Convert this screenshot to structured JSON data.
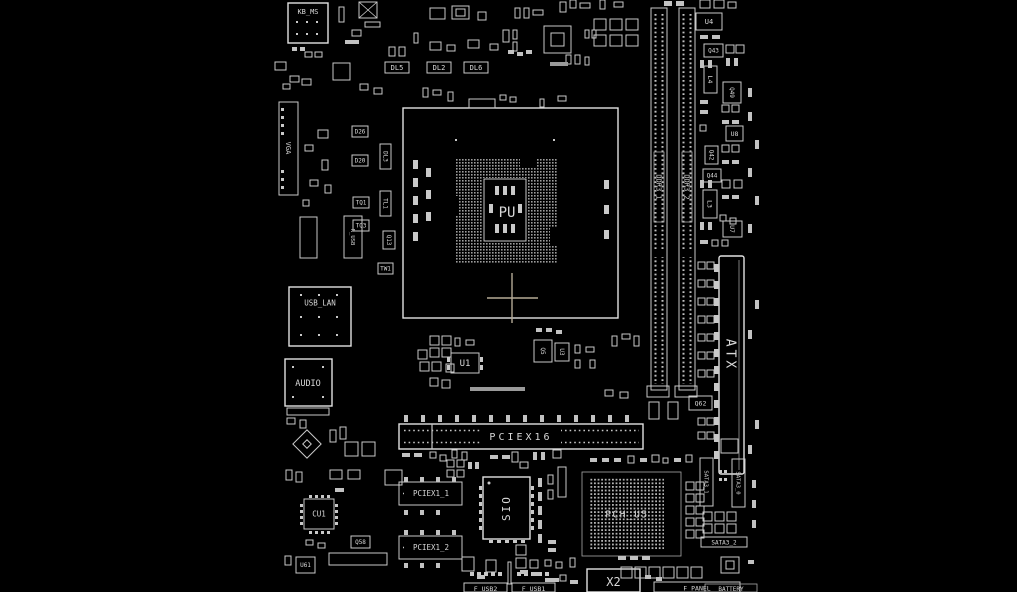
{
  "diagram": {
    "title": "motherboard-boardview",
    "colors": {
      "background": "#000000",
      "line": "#e2e2e2",
      "dim_line": "#9d9d9d",
      "text": "#d8d8d8",
      "crosshair": "#b5aa96"
    },
    "cpu": {
      "socket_label": "PU"
    },
    "connectors": {
      "kb_ms": "KB_MS",
      "vga": "VGA",
      "r_usb": "R_USB",
      "usb_lan": "USB_LAN",
      "audio": "AUDIO",
      "ddr3_1": "DDR3_1",
      "ddr3_2": "DDR3_2",
      "atx": "ATX",
      "pciex16": "PCIEX16",
      "pciex1_1": "PCIEX1_1",
      "pciex1_2": "PCIEX1_2",
      "sata3_1": "SATA3_1",
      "sata3_0": "SATA3_0",
      "sata3_2": "SATA3_2",
      "x2": "X2",
      "f_usb2": "F_USB2",
      "f_usb1": "F_USB1",
      "f_panel": "F_PANEL",
      "battery": "BATTERY"
    },
    "ics": {
      "pch": "PCH_U5",
      "sio": "SIO",
      "cu1": "CU1",
      "u1": "U1",
      "u3": "U3",
      "u4": "U4",
      "u7": "U7",
      "u8": "U8",
      "u61": "U61"
    },
    "refdes": {
      "dl2": "DL2",
      "dl3": "DL3",
      "dl5": "DL5",
      "dl6": "DL6",
      "d26": "D26",
      "d20": "D20",
      "tl1": "TL1",
      "tq1": "TQ1",
      "tq3": "TQ3",
      "tw1": "TW1",
      "q13": "Q13",
      "q42": "Q42",
      "q43": "Q43",
      "q44": "Q44",
      "q49": "Q49",
      "q5": "Q5",
      "q58": "Q58",
      "q62": "Q62",
      "l3": "L3",
      "l4": "L4"
    }
  }
}
